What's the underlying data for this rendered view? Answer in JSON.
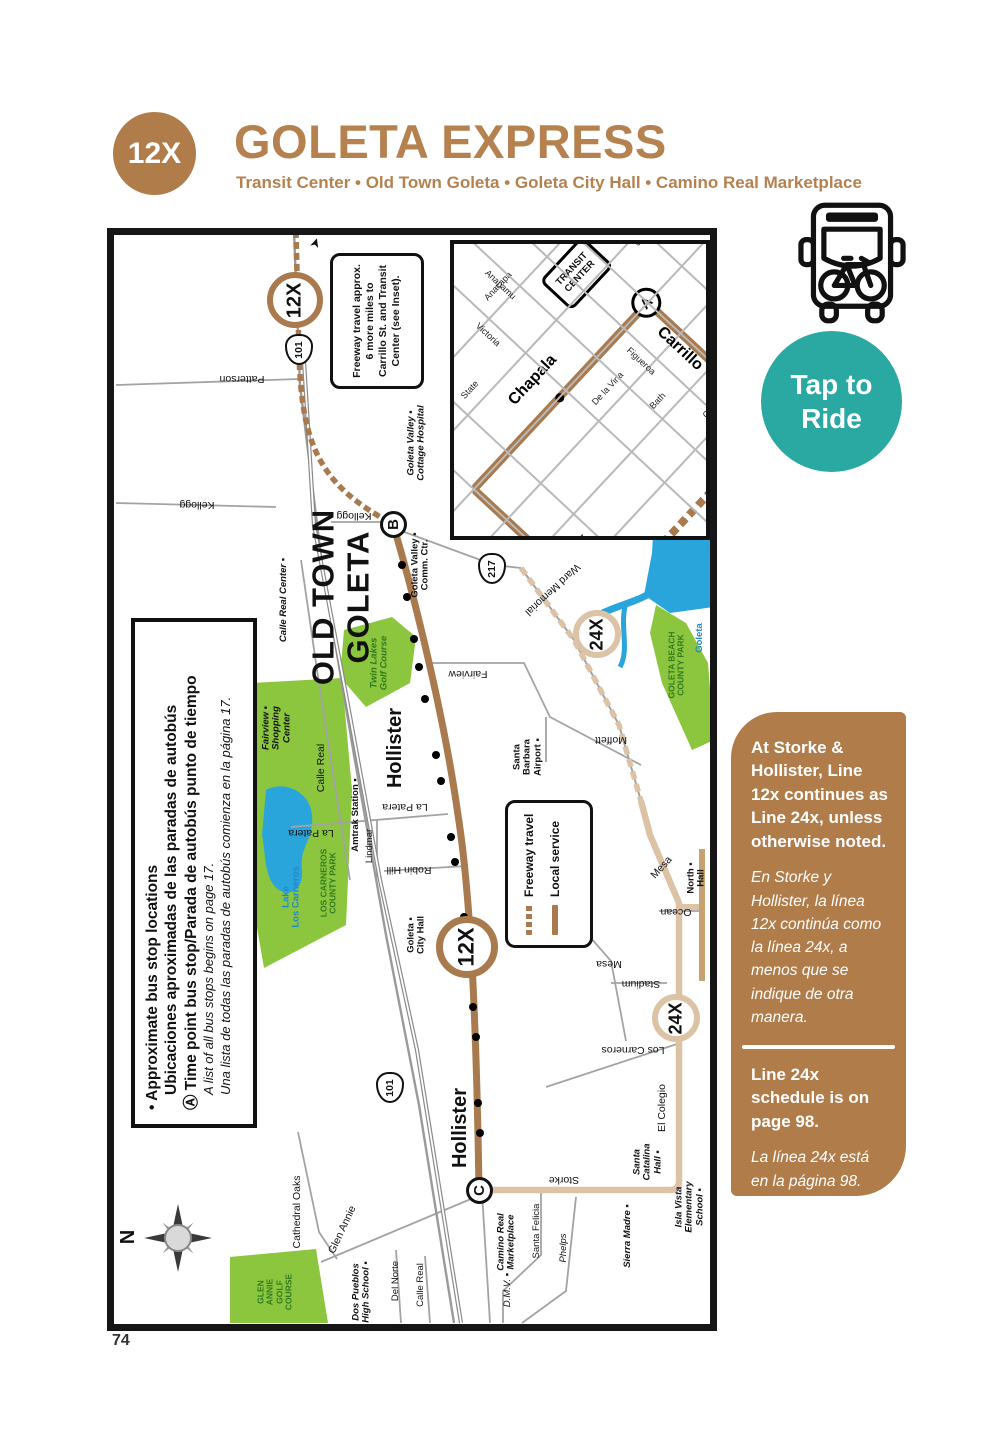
{
  "page": {
    "number": "74"
  },
  "header": {
    "route_badge": "12X",
    "title": "GOLETA EXPRESS",
    "subtitle": "Transit Center • Old Town Goleta • Goleta City Hall • Camino Real Marketplace"
  },
  "tap_to_ride": {
    "line1": "Tap to",
    "line2": "Ride"
  },
  "colors": {
    "brand_brown": "#b5824f",
    "panel_brown": "#b07c4a",
    "route_brown": "#a87a4e",
    "route_tan": "#dcc3a6",
    "teal": "#2aa9a2",
    "park_green": "#8cc63e",
    "water_blue": "#2aa5dc",
    "dark_green_text": "#2f7a1f"
  },
  "sidebar": {
    "note1_en": "At Storke & Hollister, Line 12x continues as Line 24x, unless otherwise noted.",
    "note1_es": "En Storke y Hollister, la línea 12x continúa como la línea 24x, a menos que se indique de otra manera.",
    "note2_en": "Line 24x schedule is on page 98.",
    "note2_es": "La línea 24x está en la página 98."
  },
  "map": {
    "note_box": "Freeway travel approx.\n6 more miles to\nCarrillo St. and Transit\nCenter (see Inset).",
    "legend": {
      "freeway": "Freeway travel",
      "local": "Local service"
    },
    "stop_legend": {
      "b1": "• Approximate bus stop locations",
      "b1b": "Ubicaciones aproximadas de las paradas de autobús",
      "b2": "Ⓐ Time point bus stop/Parada de autobús punto de tiempo",
      "i1": "A list of all bus stops begins on page 17.",
      "i2": "Una lista de todas las paradas de autobús comienza en la página 17."
    },
    "old_town": "OLD TOWN\nGOLETA",
    "compass_n": "N",
    "labels": [
      {
        "t": "Patterson",
        "x": 128,
        "y": 143,
        "r": 180,
        "c": ""
      },
      {
        "t": "Kellogg",
        "x": 83,
        "y": 269,
        "r": 180,
        "c": ""
      },
      {
        "t": "Kellogg",
        "x": 240,
        "y": 280,
        "r": 180,
        "c": ""
      },
      {
        "t": "Goleta Valley ▪\nCottage Hospital",
        "x": 303,
        "y": 208,
        "r": -90,
        "c": "sm bi"
      },
      {
        "t": "Goleta Valley ▪\nComm. Ctr.",
        "x": 307,
        "y": 330,
        "r": -90,
        "c": "sm b"
      },
      {
        "t": "Calle Real Center ▪",
        "x": 170,
        "y": 365,
        "r": -90,
        "c": "sm bi"
      },
      {
        "t": "Fairview ▪\nShopping\nCenter",
        "x": 163,
        "y": 493,
        "r": -90,
        "c": "sm bi"
      },
      {
        "t": "Twin Lakes\nGolf Course",
        "x": 266,
        "y": 428,
        "r": -90,
        "c": "sm bi dg"
      },
      {
        "t": "Calle Real",
        "x": 208,
        "y": 533,
        "r": -90,
        "c": ""
      },
      {
        "t": "Amtrak Station ▪",
        "x": 242,
        "y": 580,
        "r": -90,
        "c": "sm b"
      },
      {
        "t": "Hollister",
        "x": 281,
        "y": 513,
        "r": -90,
        "c": "big"
      },
      {
        "t": "La Patera",
        "x": 291,
        "y": 571,
        "r": 180,
        "c": ""
      },
      {
        "t": "La Patera",
        "x": 197,
        "y": 597,
        "r": 180,
        "c": ""
      },
      {
        "t": "Lindmar",
        "x": 256,
        "y": 611,
        "r": -90,
        "c": "sm"
      },
      {
        "t": "Robin Hill",
        "x": 295,
        "y": 634,
        "r": 180,
        "c": ""
      },
      {
        "t": "Lake\nLos Carneros",
        "x": 178,
        "y": 662,
        "r": -90,
        "c": "sm b blue"
      },
      {
        "t": "LOS CARNEROS\nCOUNTY PARK",
        "x": 215,
        "y": 648,
        "r": -90,
        "c": "xs b dg"
      },
      {
        "t": "Goleta ▪\nCity Hall",
        "x": 303,
        "y": 700,
        "r": -90,
        "c": "sm b"
      },
      {
        "t": "Fairview",
        "x": 354,
        "y": 438,
        "r": 180,
        "c": ""
      },
      {
        "t": "Santa\nBarbara\nAirport ▪",
        "x": 414,
        "y": 522,
        "r": -90,
        "c": "sm b"
      },
      {
        "t": "Moffett",
        "x": 497,
        "y": 504,
        "r": 180,
        "c": ""
      },
      {
        "t": "Ward Memorial",
        "x": 438,
        "y": 354,
        "r": 137,
        "c": ""
      },
      {
        "t": "Goleta",
        "x": 586,
        "y": 403,
        "r": -90,
        "c": "sm b blue"
      },
      {
        "t": "GOLETA BEACH\nCOUNTY PARK",
        "x": 563,
        "y": 430,
        "r": -90,
        "c": "xs b dg"
      },
      {
        "t": "Mesa",
        "x": 548,
        "y": 633,
        "r": -48,
        "c": ""
      },
      {
        "t": "North ▪\nHall",
        "x": 583,
        "y": 643,
        "r": -90,
        "c": "sm b"
      },
      {
        "t": "Ocean",
        "x": 562,
        "y": 676,
        "r": 180,
        "c": ""
      },
      {
        "t": "Mesa",
        "x": 495,
        "y": 728,
        "r": 180,
        "c": ""
      },
      {
        "t": "Stadium",
        "x": 527,
        "y": 748,
        "r": 180,
        "c": ""
      },
      {
        "t": "Los Carneros",
        "x": 519,
        "y": 814,
        "r": 180,
        "c": ""
      },
      {
        "t": "El Colegio",
        "x": 549,
        "y": 873,
        "r": -90,
        "c": ""
      },
      {
        "t": "Hollister",
        "x": 346,
        "y": 893,
        "r": -90,
        "c": "big"
      },
      {
        "t": "Storke",
        "x": 450,
        "y": 944,
        "r": 180,
        "c": ""
      },
      {
        "t": "Camino Real\nMarketplace",
        "x": 393,
        "y": 1007,
        "r": -90,
        "c": "sm bi"
      },
      {
        "t": "Santa Felicia",
        "x": 423,
        "y": 996,
        "r": -90,
        "c": "sm"
      },
      {
        "t": "Phelps",
        "x": 450,
        "y": 1013,
        "r": -90,
        "c": "sm i"
      },
      {
        "t": "D.M.V. ▪",
        "x": 394,
        "y": 1055,
        "r": -90,
        "c": "sm i"
      },
      {
        "t": "Sierra Madre ▪",
        "x": 514,
        "y": 1001,
        "r": -90,
        "c": "sm bi"
      },
      {
        "t": "Santa\nCatalina\nHall ▪",
        "x": 534,
        "y": 927,
        "r": -90,
        "c": "sm bi"
      },
      {
        "t": "Isla Vista\nElementary\nSchool ▪",
        "x": 576,
        "y": 972,
        "r": -90,
        "c": "sm bi"
      },
      {
        "t": "Cathedral Oaks",
        "x": 184,
        "y": 977,
        "r": -90,
        "c": ""
      },
      {
        "t": "Glen Annie",
        "x": 229,
        "y": 995,
        "r": -65,
        "c": ""
      },
      {
        "t": "GLEN\nANNIE\nGOLF\nCOURSE",
        "x": 161,
        "y": 1057,
        "r": -90,
        "c": "xs b dg"
      },
      {
        "t": "Dos Pueblos\nHigh School ▪",
        "x": 248,
        "y": 1057,
        "r": -90,
        "c": "sm bi"
      },
      {
        "t": "Del Norte",
        "x": 282,
        "y": 1046,
        "r": -90,
        "c": "sm"
      },
      {
        "t": "Calle Real",
        "x": 307,
        "y": 1050,
        "r": -90,
        "c": "sm"
      },
      {
        "t": "N",
        "x": 14,
        "y": 1002,
        "r": -90,
        "c": "big"
      }
    ],
    "shields": [
      {
        "t": "101",
        "x": 183,
        "y": 112
      },
      {
        "t": "217",
        "x": 376,
        "y": 331
      },
      {
        "t": "101",
        "x": 274,
        "y": 850
      }
    ],
    "badges": [
      {
        "t": "12X",
        "x": 181,
        "y": 65,
        "d": 56,
        "ring": "#a87a4e",
        "rw": 6,
        "fs": 20
      },
      {
        "t": "12X",
        "x": 353,
        "y": 712,
        "d": 62,
        "ring": "#a87a4e",
        "rw": 7,
        "fs": 22
      },
      {
        "t": "24X",
        "x": 483,
        "y": 399,
        "d": 48,
        "ring": "#dcc3a6",
        "rw": 6,
        "fs": 18
      },
      {
        "t": "24X",
        "x": 562,
        "y": 783,
        "d": 48,
        "ring": "#dcc3a6",
        "rw": 6,
        "fs": 18
      },
      {
        "t": "B",
        "x": 279,
        "y": 289,
        "d": 27,
        "ring": "#111111",
        "rw": 3,
        "fs": 15
      },
      {
        "t": "C",
        "x": 365,
        "y": 955,
        "d": 27,
        "ring": "#111111",
        "rw": 3,
        "fs": 15
      }
    ],
    "stops": [
      [
        288,
        330
      ],
      [
        293,
        362
      ],
      [
        300,
        404
      ],
      [
        305,
        432
      ],
      [
        311,
        464
      ],
      [
        322,
        520
      ],
      [
        327,
        546
      ],
      [
        337,
        602
      ],
      [
        341,
        627
      ],
      [
        350,
        682
      ],
      [
        354,
        707
      ],
      [
        359,
        772
      ],
      [
        362,
        802
      ],
      [
        364,
        868
      ],
      [
        366,
        898
      ]
    ]
  },
  "inset": {
    "transit_center": "TRANSIT\nCENTER",
    "stop_a": "A",
    "shield": "101",
    "h_streets": [
      {
        "t": "Anacapa",
        "y": 195,
        "lx": 330,
        "ly": 184,
        "c": "xs"
      },
      {
        "t": "State",
        "y": 245,
        "lx": 235,
        "ly": 234,
        "c": "xs"
      },
      {
        "t": "Chapala",
        "y": 300,
        "lx": 285,
        "ly": 278,
        "c": "ibig"
      },
      {
        "t": "De la Vina",
        "y": 345,
        "lx": 330,
        "ly": 334,
        "c": "xs"
      },
      {
        "t": "Bath",
        "y": 390,
        "lx": 355,
        "ly": 379,
        "c": "xs"
      },
      {
        "t": "Castillo",
        "y": 435,
        "lx": 390,
        "ly": 424,
        "c": "xs"
      },
      {
        "t": "San Andres",
        "y": 545,
        "lx": 470,
        "ly": 534,
        "c": "xs"
      }
    ],
    "v_streets": [
      {
        "t": "Islay",
        "x": 55,
        "ly": 500,
        "c": "xs"
      },
      {
        "t": "Valerio",
        "x": 110,
        "ly": 480,
        "c": "xs"
      },
      {
        "t": "Arrellaga",
        "x": 165,
        "ly": 495,
        "c": "ibig2"
      },
      {
        "t": "Micheltorena",
        "x": 215,
        "ly": 435,
        "c": "xs"
      },
      {
        "t": "Victoria",
        "x": 300,
        "ly": 205,
        "c": "xs"
      },
      {
        "t": "Anapamu",
        "x": 345,
        "ly": 180,
        "c": "xs"
      },
      {
        "t": "Figueroa",
        "x": 385,
        "ly": 335,
        "c": "xs"
      },
      {
        "t": "Carrillo",
        "x": 420,
        "ly": 355,
        "c": "ibig"
      },
      {
        "t": "Canon Perdido",
        "x": 470,
        "ly": 225,
        "c": "xs"
      },
      {
        "t": "De la Guerra",
        "x": 520,
        "ly": 195,
        "c": "xs"
      },
      {
        "t": "Ortega",
        "x": 570,
        "ly": 165,
        "c": "xs"
      }
    ]
  }
}
